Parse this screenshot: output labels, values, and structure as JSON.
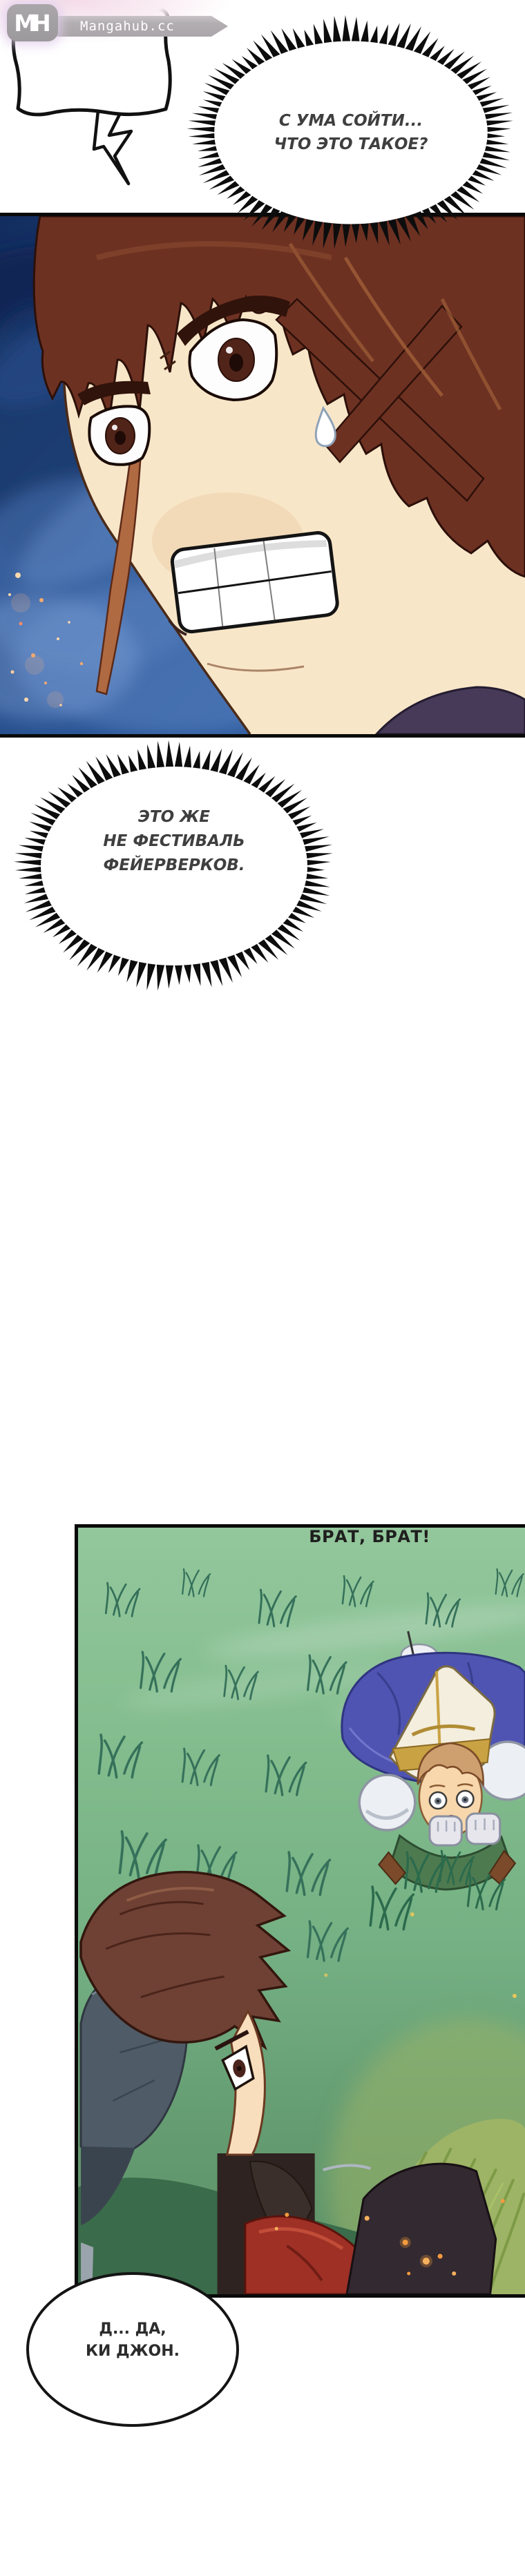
{
  "site": {
    "logo_text": "MH",
    "name": "Mangahub.cc"
  },
  "speech": {
    "scream": {
      "line1": "С УМА СОЙТИ...",
      "line2": "ЧТО ЭТО ТАКОЕ?"
    },
    "fireworks": {
      "line1": "ЭТО ЖЕ",
      "line2": "НЕ ФЕСТИВАЛЬ",
      "line3": "ФЕЙЕРВЕРКОВ."
    },
    "call": {
      "line1": "БРАТ, БРАТ!"
    },
    "reply": {
      "line1": "Д... ДА,",
      "line2": "КИ ДЖОН."
    }
  },
  "colors": {
    "bubble_border": "#0d0d0d",
    "bubble_text": "#3f3f3f",
    "header_bar": "#b3aeb1",
    "logo_bg": "#9c999c",
    "header_glow": "#f4dce8",
    "panel_border": "#0a0a0a",
    "night_sky": "#2a5494",
    "grass_field": "#7fba8b",
    "spark_orange": "#f7a86e"
  }
}
